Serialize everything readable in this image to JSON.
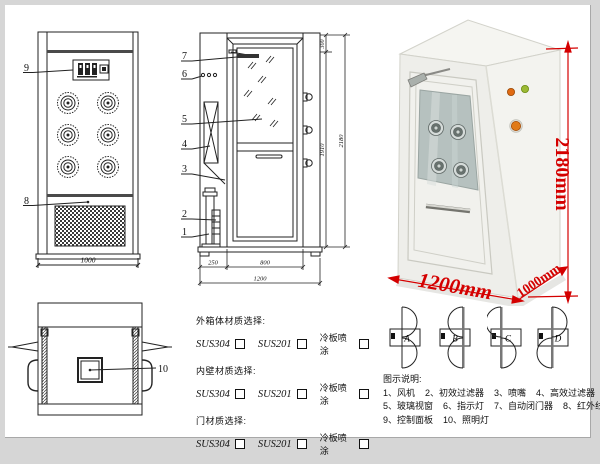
{
  "front_view": {
    "callout_9": "9",
    "callout_8": "8",
    "dim_width": "1000"
  },
  "side_view": {
    "callout_7": "7",
    "callout_6": "6",
    "callout_5": "5",
    "callout_4": "4",
    "callout_3": "3",
    "callout_2": "2",
    "callout_1": "1",
    "dim_top": "300",
    "dim_door_height": "1910",
    "dim_total_height": "2180",
    "dim_left": "250",
    "dim_door_width": "800",
    "dim_total_width": "1200"
  },
  "top_view": {
    "callout_10": "10"
  },
  "materials": {
    "outer_title": "外箱体材质选择:",
    "inner_title": "内壁材质选择:",
    "door_title": "门材质选择:",
    "opt_sus304": "SUS304",
    "opt_sus201": "SUS201",
    "opt_coldplate": "冷板喷涂"
  },
  "photo": {
    "dim_height": "2180mm",
    "dim_width": "1200mm",
    "dim_depth": "1000mm",
    "dim_color": "#d40000"
  },
  "door_configs": {
    "a": "A",
    "b": "B",
    "c": "C",
    "d": "D"
  },
  "legend": {
    "title": "图示说明:",
    "line1": "1、风机    2、初效过滤器    3、喷嘴    4、高效过滤器",
    "line2": "5、玻璃视窗    6、指示灯    7、自动闭门器    8、红外线感应器",
    "line3": "9、控制面板    10、照明灯"
  }
}
